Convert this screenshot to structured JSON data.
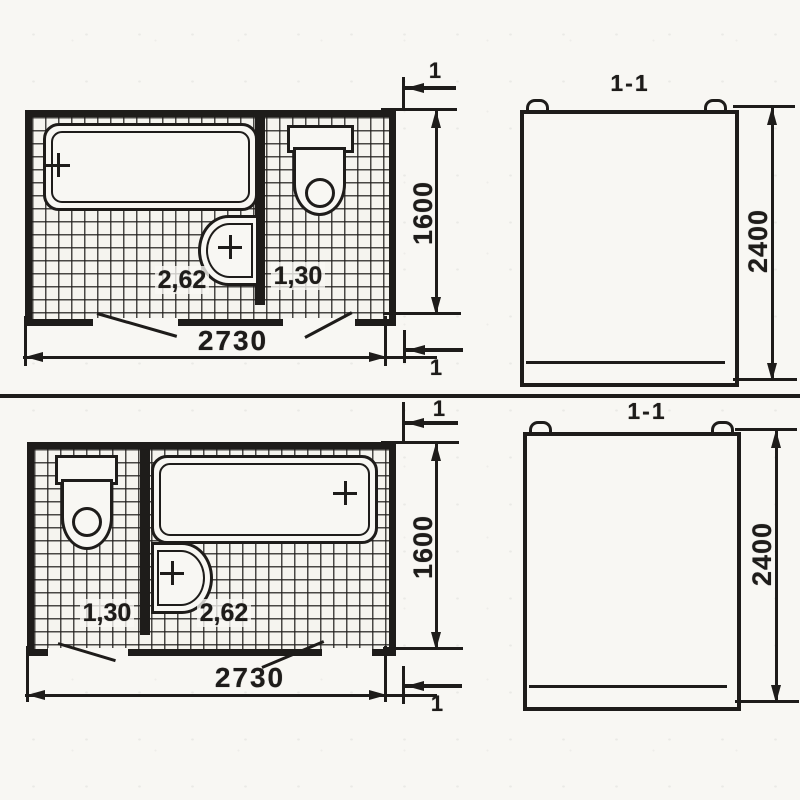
{
  "drawing": {
    "colors": {
      "ink": "#1e1c1a",
      "paper": "#f8f7f3"
    },
    "variants": [
      {
        "plan": {
          "area_bathroom": "2,62",
          "area_wc": "1,30",
          "width": "2730",
          "depth": "1600"
        },
        "section": {
          "label": "1-1",
          "height": "2400"
        },
        "cut_mark": "1"
      },
      {
        "plan": {
          "area_bathroom": "2,62",
          "area_wc": "1,30",
          "width": "2730",
          "depth": "1600"
        },
        "section": {
          "label": "1-1",
          "height": "2400"
        },
        "cut_mark": "1"
      }
    ]
  }
}
